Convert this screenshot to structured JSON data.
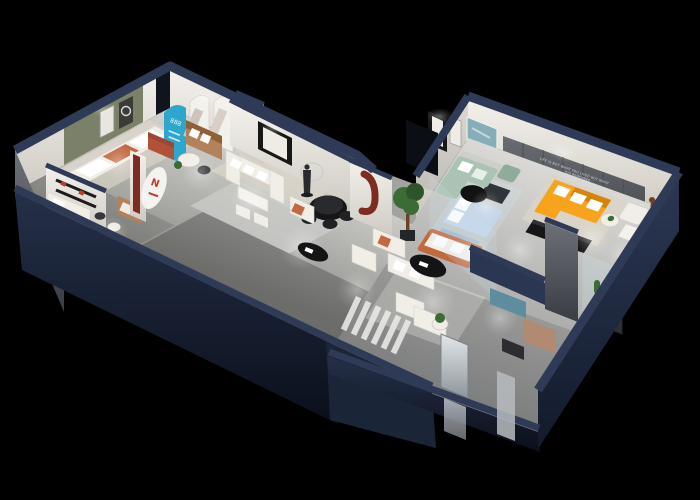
{
  "scene": {
    "title": "3D isometric cutaway floor plan render of a furniture showroom on a black background",
    "view": "isometric cutaway, two angled wings meeting at a corner",
    "background": "#000000"
  },
  "texts": {
    "wall_slogan_line1": "LIFE IS NOT WHAT YOU LIVED BUT WHAT",
    "wall_slogan_line2": "YOU REMEMBER",
    "arch_panel_number": "888",
    "logo_mark": "N"
  },
  "palette": {
    "bg": "#000000",
    "wall_cap": "#2e3a56",
    "navy_face": "#1b2538",
    "navy_face_dark": "#0c111d",
    "navy_face_light": "#2b3752",
    "gray_face_a": "#6d7177",
    "gray_face_b": "#393d43",
    "wall_white": "#f2efe9",
    "wall_white_shade": "#d3cfc8",
    "wall_olive": "#7b8069",
    "wall_slogan": "#5d6064",
    "slogan_text": "#d7dadd",
    "floor_a": "#d6d5d2",
    "floor_b": "#8f908c",
    "rug_beige": "#dbd5c8",
    "rug_gray": "#cbccc8",
    "sofa_white": "#f1eee8",
    "sofa_white_shade": "#d8d3cb",
    "sofa_tan": "#b3815a",
    "sofa_tan_dark": "#8f6037",
    "cushion_terracotta": "#c4683f",
    "ottoman_rust": "#b0523a",
    "sofa_orange": "#f7a31b",
    "sofa_orange_dark": "#d98408",
    "sofa_sage": "#abc3b2",
    "sage_dark": "#8fac9a",
    "arch_cyan": "#2fa7cd",
    "arch_red": "#7e2b22",
    "arch_red_light": "#a04436",
    "door_green": "#697a5e",
    "table_black": "#161617",
    "art_frame": "#171717",
    "art_teal": "#86aeba",
    "plant_green": "#3c6b36",
    "plant_dark": "#2e5429",
    "bed_blue": "#c5d6e8",
    "bed_blue_dark": "#9fb6cf",
    "ottoman_teal": "#5f8da0",
    "recliner_tan": "#b28a74",
    "bear_brown": "#6f4026",
    "glass_tint": "#cfe4ee",
    "mirror_a": "#e3e7ea",
    "mirror_b": "#8e959b"
  },
  "rooms": [
    {
      "name": "olive display lounge",
      "items": [
        "olive accent wall with two framed artworks",
        "white sofa with terracotta cushion",
        "area rug",
        "round side table"
      ]
    },
    {
      "name": "arch gallery",
      "items": [
        "cyan arched display panel with 888 graphic",
        "two white arched poster panels",
        "green door",
        "rust ottoman",
        "tan two-seat sofa",
        "round white table",
        "black chair",
        "potted plant"
      ]
    },
    {
      "name": "central showroom",
      "items": [
        "dark red arched niche",
        "white U-shaped sectional sofa",
        "white dining table with chairs",
        "black framed wall art",
        "circle wall sketch",
        "dark figure sculpture",
        "black round dining table with chairs",
        "armchair with terracotta cushion",
        "white column with dark red arch motif"
      ]
    },
    {
      "name": "front left room",
      "items": [
        "daybed with white mattress",
        "black wall shelf with red accents",
        "long black sideboard",
        "white stool",
        "tan armchair",
        "white oval sign with red logo",
        "dark red wall strip"
      ]
    },
    {
      "name": "sage lounge",
      "items": [
        "sage green sectional sofa",
        "black round coffee table",
        "sage ottoman",
        "teal abstract wall art",
        "black framed artworks"
      ]
    },
    {
      "name": "orange lounge",
      "items": [
        "orange L-shaped sofa with white pillows",
        "black media console",
        "dark feature wall with white slogan and spotlight",
        "round side table",
        "white armchair",
        "brown teddy bear figure"
      ]
    },
    {
      "name": "glass bedroom",
      "items": [
        "glass partition walls",
        "light blue bed with white pillows",
        "light blue bench",
        "green potted tree",
        "white sofa with terracotta frame",
        "black oval coffee table"
      ]
    },
    {
      "name": "bottom lounge",
      "items": [
        "pair of white armchairs",
        "potted plant on side table",
        "teal ottoman",
        "tan recliner chair",
        "dark pillar",
        "glass plant display case with cacti",
        "tall mirror panel",
        "striped walkway ramp"
      ]
    }
  ]
}
